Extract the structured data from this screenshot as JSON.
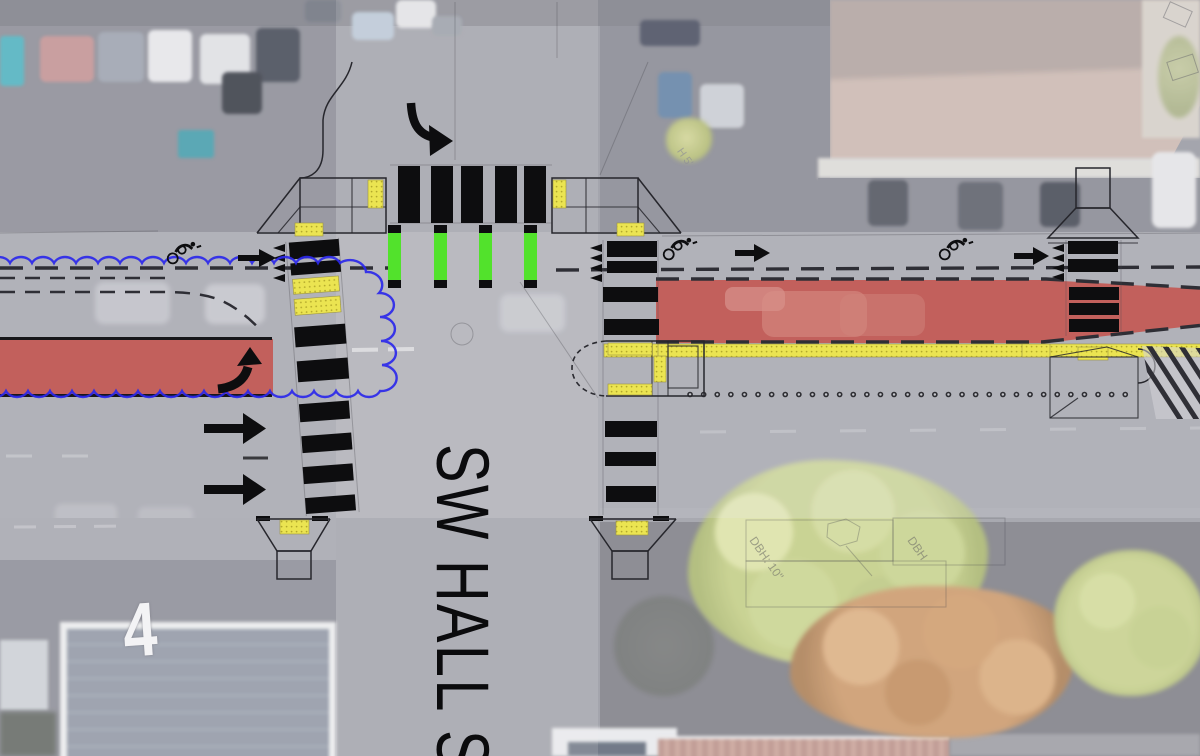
{
  "street_label": {
    "text": "SW HALL S"
  },
  "photo": {
    "rooftop_number": "4"
  },
  "annotations": {
    "tree_1": "DBH: 10\"",
    "tree_2": "DBH",
    "curb": "H 5'"
  },
  "colors": {
    "red_lane": "#c5504a",
    "bike_green": "#52e22c",
    "tactile_yellow": "#ebe451",
    "cloud_blue": "#2b28ea",
    "marking_black": "#0d0d0f",
    "road_gray": "#96979f"
  },
  "icons": {
    "bike_symbol": "cyclist-glyph",
    "lane_arrow": "→",
    "turn_right_arrow": "↱",
    "merge_up_arrow": "↑",
    "yield_teeth": "◄"
  }
}
